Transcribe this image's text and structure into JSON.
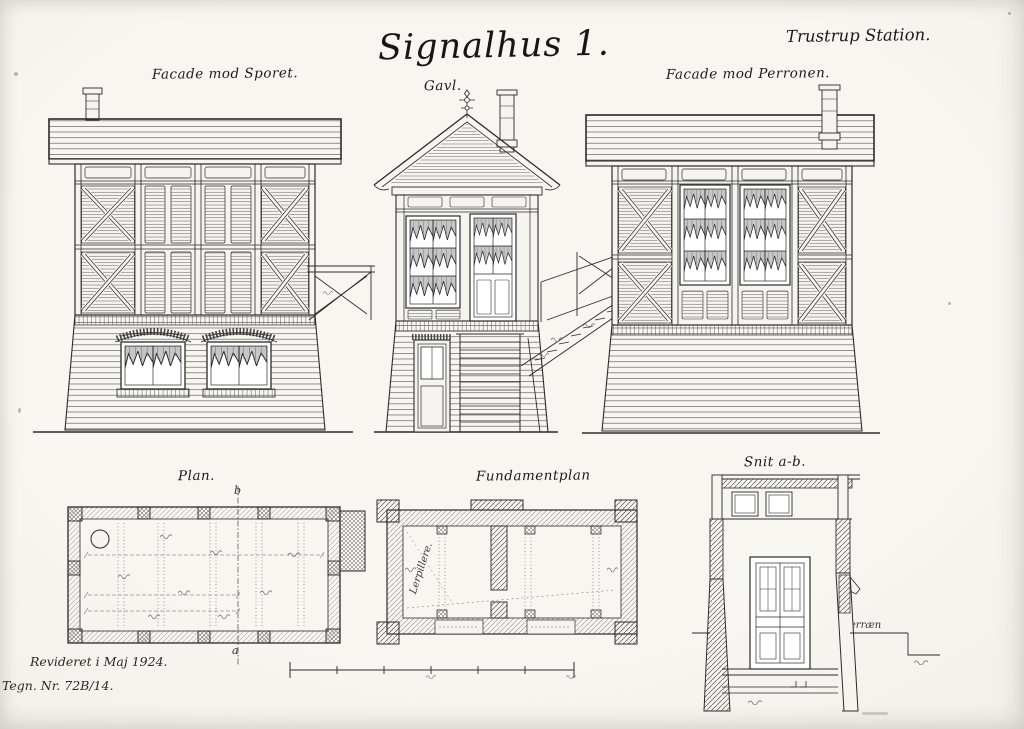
{
  "page": {
    "title": "Signalhus 1.",
    "station": "Trustrup Station.",
    "revision": "Revideret i Maj 1924.",
    "drawing_no": "Tegn. Nr. 72B/14."
  },
  "drawings": {
    "facade_track": {
      "label": "Facade mod Sporet."
    },
    "gable": {
      "label": "Gavl."
    },
    "facade_platform": {
      "label": "Facade mod Perronen."
    },
    "plan": {
      "label": "Plan.",
      "mark_top": "b",
      "mark_bottom": "a"
    },
    "foundation": {
      "label": "Fundamentplan",
      "annotation": "Lerpillere."
    },
    "section": {
      "label": "Snit a-b.",
      "terrain": "Terræn"
    }
  }
}
